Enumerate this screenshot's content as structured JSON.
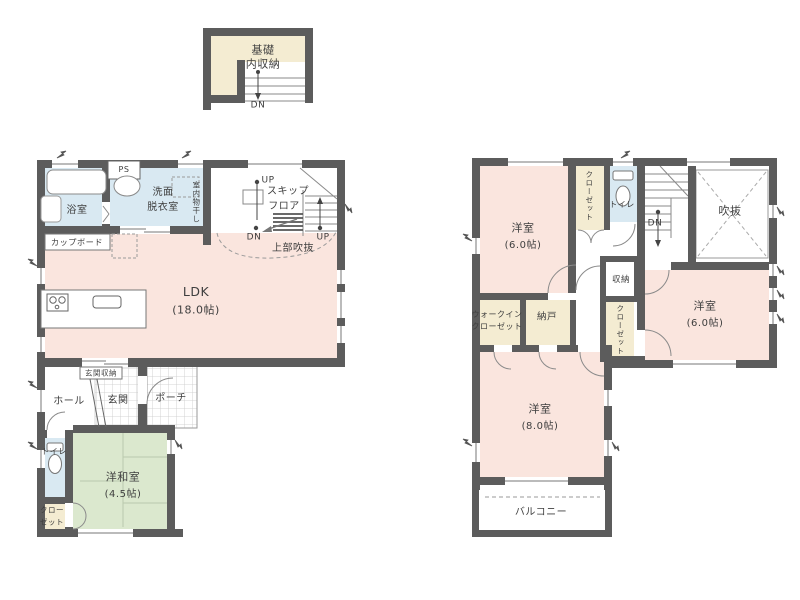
{
  "title": "間取り図",
  "colors": {
    "wall": "#5c5c5c",
    "room_pink": "#fae5de",
    "water_blue": "#d9e9f2",
    "closet_cream": "#f4ecd2",
    "tatami_green": "#dbe8ce",
    "tile_line": "#c9c9c9",
    "text": "#3e3e3e"
  },
  "labels": {
    "basement": {
      "line1": "基礎",
      "line2": "内収納",
      "dn": "DN"
    },
    "f1": {
      "bath": "浴室",
      "ps": "PS",
      "senmen1": "洗面",
      "senmen2": "脱衣室",
      "monohoshi": "室内物干し",
      "skip1": "スキップ",
      "skip2": "フロア",
      "up_left": "UP",
      "dn": "DN",
      "up_right": "UP",
      "joubu": "上部吹抜",
      "cupboard": "カップボード",
      "ldk": "LDK",
      "ldk_size": "(18.0帖)",
      "genkan_shuno": "玄関収納",
      "hall": "ホール",
      "genkan": "玄関",
      "porch": "ポーチ",
      "toilet": "トイレ",
      "washitsu": "洋和室",
      "washitsu_size": "(4.5帖)",
      "closet1": "クロー",
      "closet2": "ゼット"
    },
    "f2": {
      "room_nw": "洋室",
      "room_nw_size": "(6.0帖)",
      "closet_nw": "クローゼット",
      "toilet": "トイレ",
      "dn": "DN",
      "fukinuke": "吹抜",
      "shuno": "収納",
      "room_e": "洋室",
      "room_e_size": "(6.0帖)",
      "wic1": "ウォークイン",
      "wic2": "クローゼット",
      "nando": "納戸",
      "closet_e": "クローゼット",
      "room_s": "洋室",
      "room_s_size": "(8.0帖)",
      "balcony": "バルコニー"
    }
  }
}
